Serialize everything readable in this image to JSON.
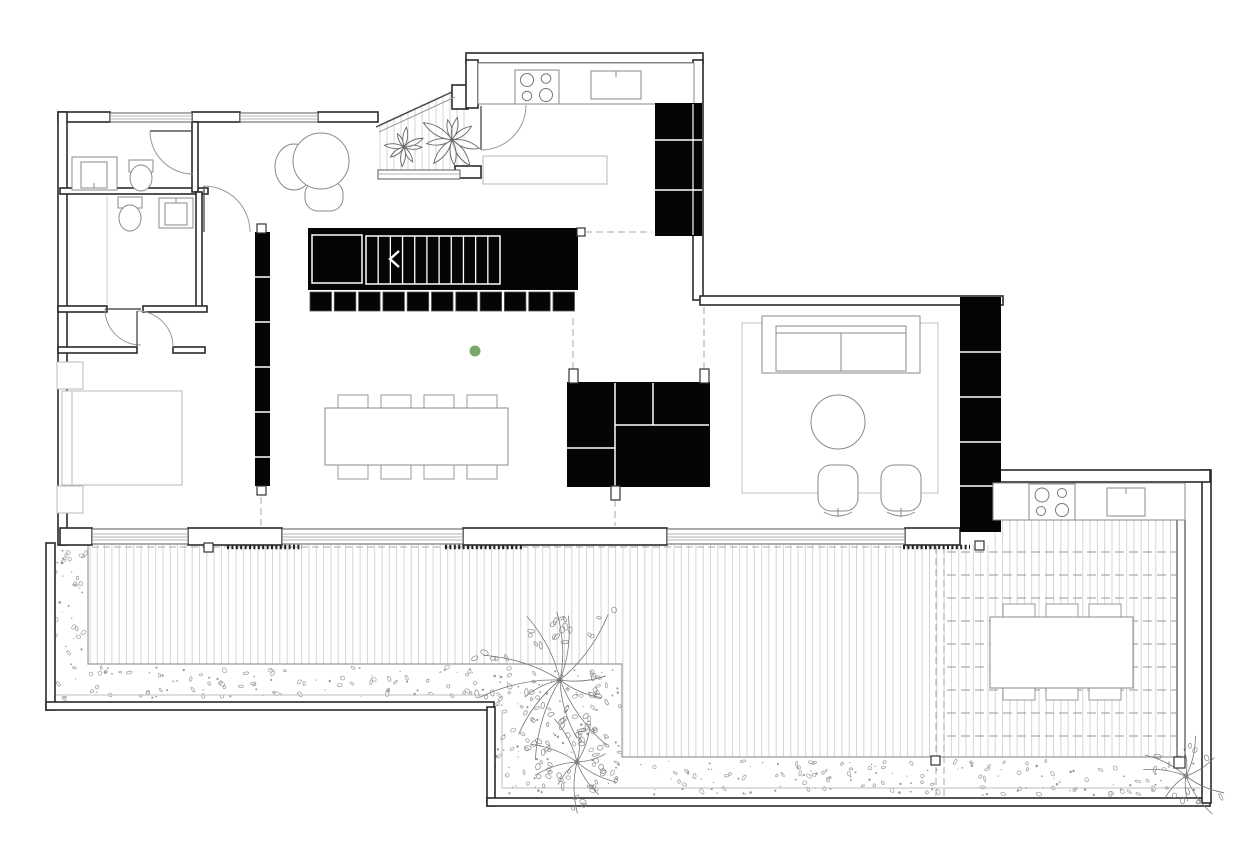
{
  "plan": {
    "type": "architectural-floor-plan",
    "floor": "ground",
    "colors": {
      "background": "#ffffff",
      "wall_line": "#2a2a2a",
      "line_mid": "#8a8a8a",
      "line_light": "#b8b8b8",
      "deck_plank": "#d6d6d6",
      "gravel": "#9a9a9a",
      "dash_line": "#a8a8a8",
      "black_fill": "#050505",
      "accent_dot": "#7aa86c"
    },
    "counts": {
      "stair_treads": 10,
      "stair_storage_cubbies": 11,
      "dining_chairs": 8,
      "outdoor_dining_chairs": 6,
      "cooktop_burners_indoor": 4,
      "cooktop_burners_outdoor": 4,
      "wardrobe_segments": 6,
      "kitchen_tall_cabinet_segments": 3,
      "living_storage_segments": 5,
      "swivel_chairs": 2,
      "patio_plants": 2,
      "garden_trees": 3,
      "pergola_louver_lines": 9
    },
    "rooms": [
      {
        "name": "bathroom-1",
        "features": [
          "vanity-sink",
          "toilet",
          "door"
        ]
      },
      {
        "name": "bathroom-2",
        "features": [
          "toilet",
          "sink",
          "shower-screen",
          "door"
        ]
      },
      {
        "name": "bedroom",
        "features": [
          "double-bed",
          "nightstand",
          "nightstand",
          "door"
        ]
      },
      {
        "name": "hallway",
        "features": [
          "lounge-chair",
          "black-wardrobe-wall"
        ]
      },
      {
        "name": "entry-patio",
        "features": [
          "plant",
          "plant",
          "wood-decking",
          "glazed-corner"
        ]
      },
      {
        "name": "kitchen",
        "features": [
          "counter",
          "cooktop",
          "sink",
          "island",
          "tall-black-cabinets",
          "door-to-patio"
        ]
      },
      {
        "name": "staircase",
        "features": [
          "treads",
          "direction-arrow",
          "storage-cubbies"
        ]
      },
      {
        "name": "dining-area",
        "features": [
          "table-for-8",
          "green-column-marker"
        ]
      },
      {
        "name": "living-room",
        "features": [
          "rug",
          "sofa",
          "round-coffee-table",
          "swivel-chairs",
          "black-storage-wall"
        ]
      },
      {
        "name": "outdoor-kitchen",
        "features": [
          "counter",
          "cooktop",
          "sink"
        ]
      },
      {
        "name": "outdoor-dining",
        "features": [
          "table-for-6",
          "pergola-louvers"
        ]
      },
      {
        "name": "terrace",
        "features": [
          "wood-deck",
          "gravel-border",
          "trees",
          "shrub"
        ]
      }
    ]
  }
}
